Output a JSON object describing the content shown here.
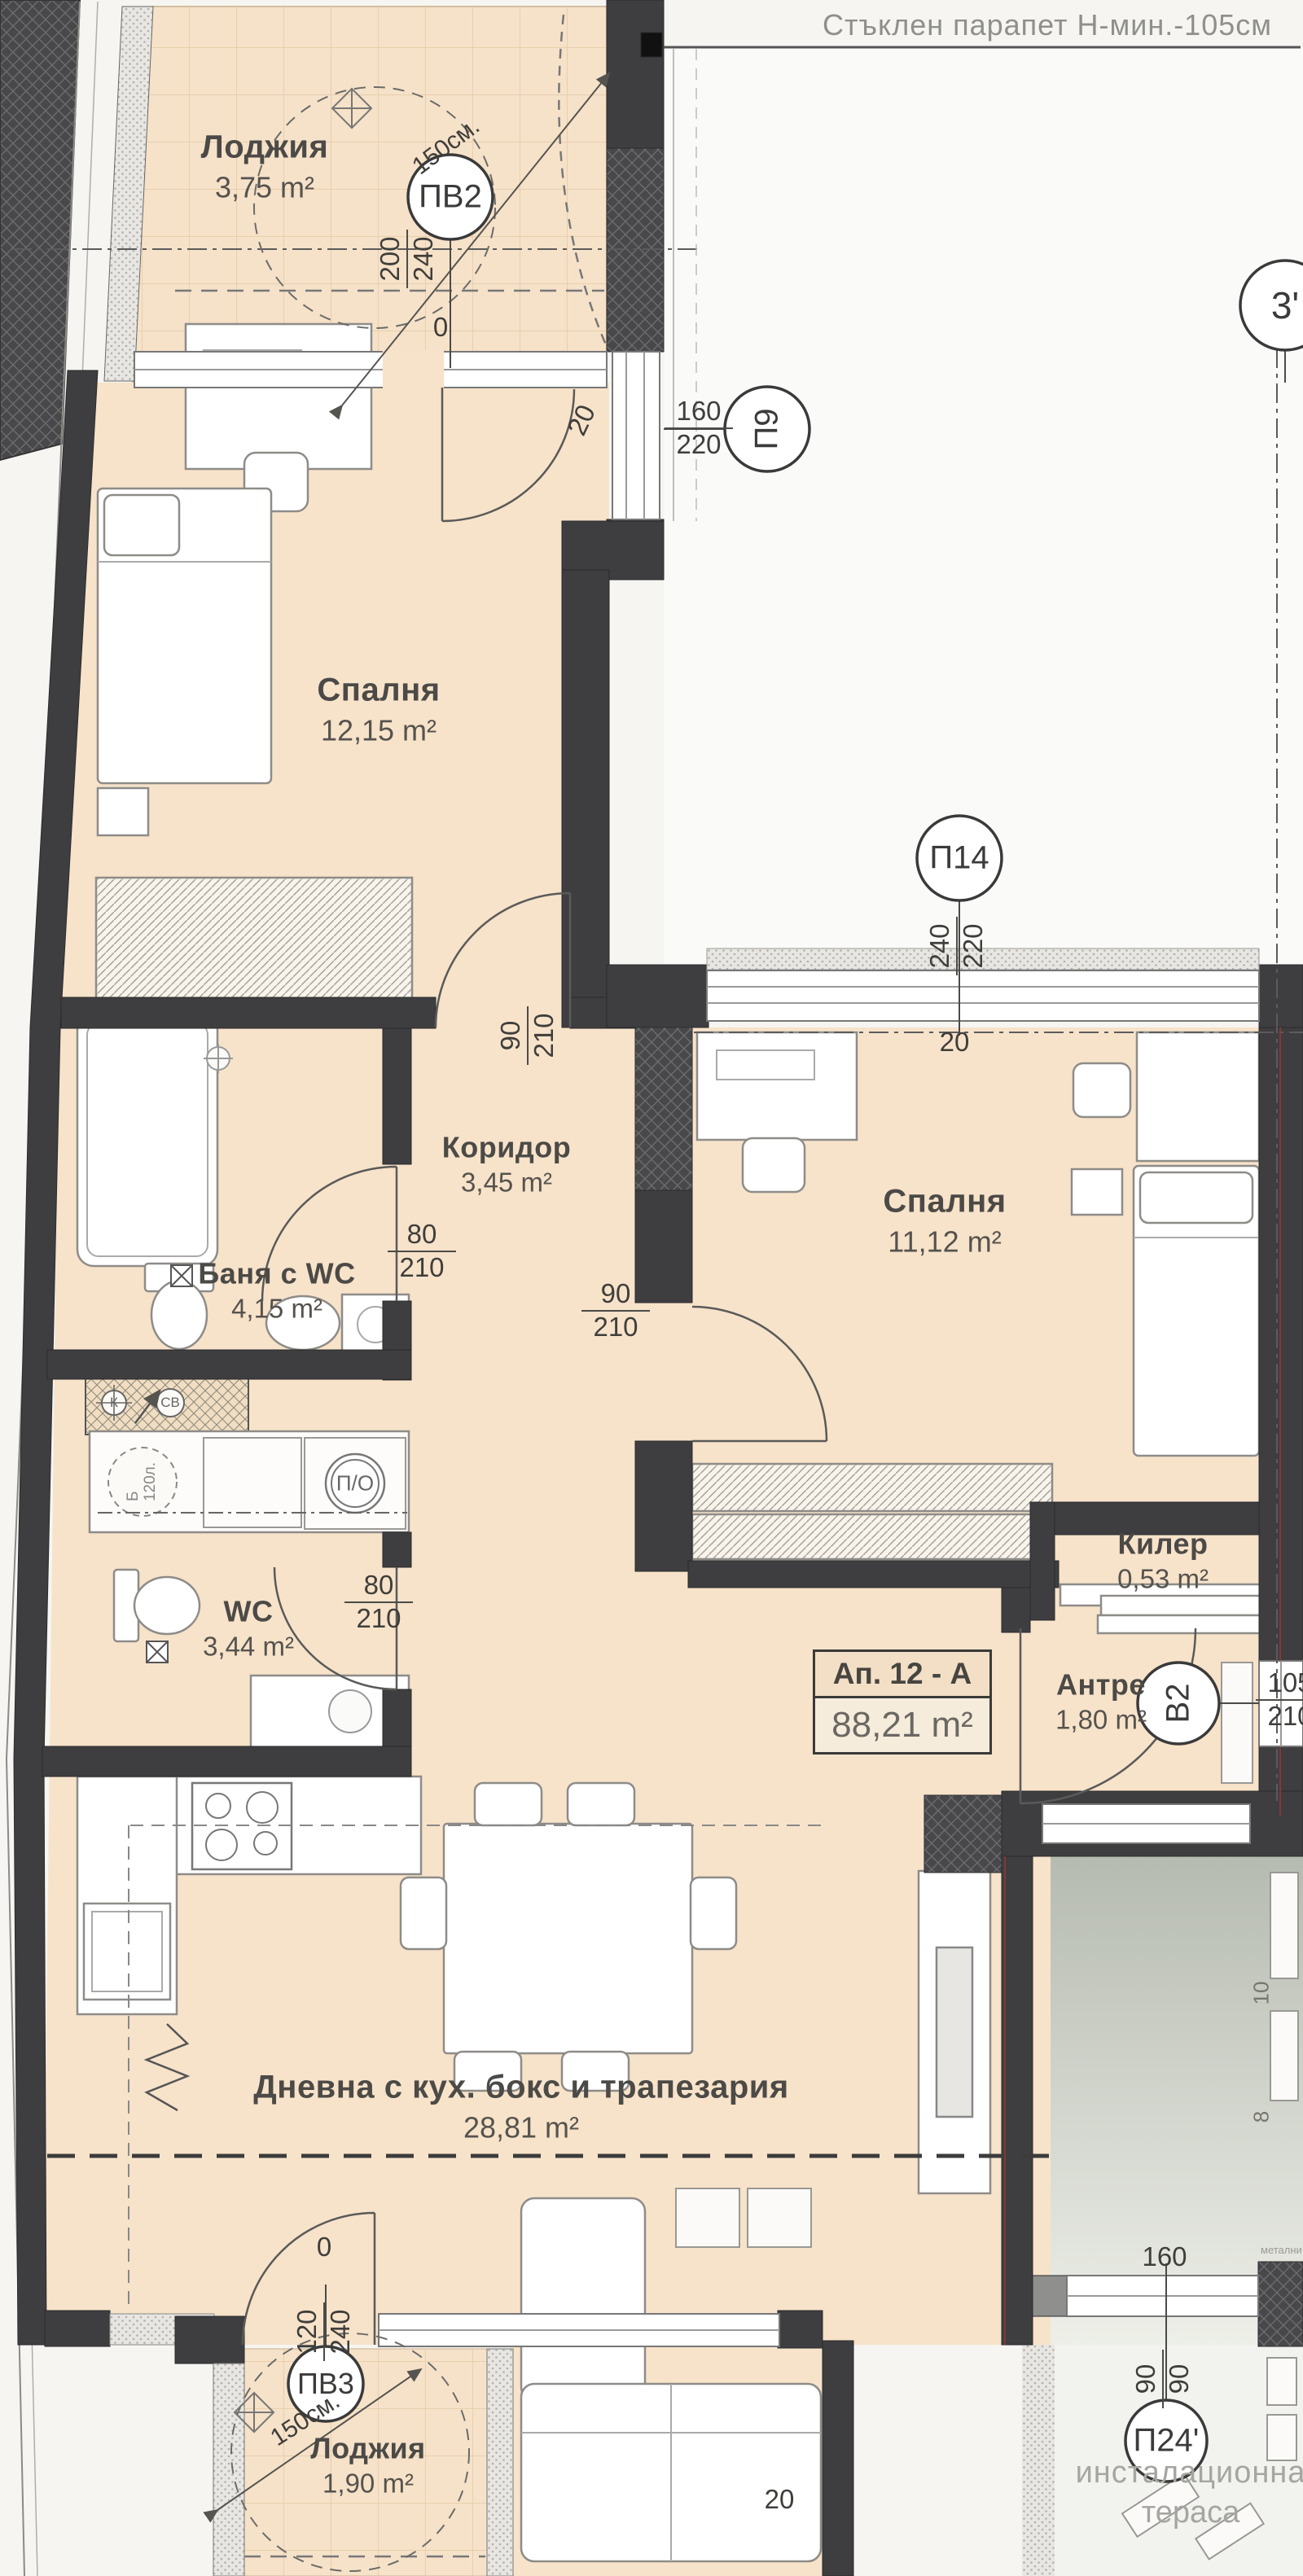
{
  "note_top": "Стъклен парапет Н-мин.-105см",
  "apartment_box": {
    "name": "Ап. 12 - А",
    "area": "88,21 m²"
  },
  "rooms": {
    "loggia_top": {
      "name": "Лоджия",
      "area": "3,75 m²"
    },
    "bedroom1": {
      "name": "Спалня",
      "area": "12,15 m²"
    },
    "corridor": {
      "name": "Коридор",
      "area": "3,45 m²"
    },
    "bath": {
      "name": "Баня с WC",
      "area": "4,15 m²"
    },
    "wc": {
      "name": "WC",
      "area": "3,44 m²"
    },
    "bedroom2": {
      "name": "Спалня",
      "area": "11,12 m²"
    },
    "storage": {
      "name": "Килер",
      "area": "0,53 m²"
    },
    "entry": {
      "name": "Антре",
      "area": "1,80 m²"
    },
    "living": {
      "name": "Дневна с кух. бокс и трапезария",
      "area": "28,81 m²"
    },
    "loggia_bottom": {
      "name": "Лоджия",
      "area": "1,90 m²"
    },
    "terrace": {
      "line1": "инсталационна",
      "line2": "тераса"
    }
  },
  "markers": {
    "pv2": "ПВ2",
    "p9": "П9",
    "p14": "П14",
    "v2": "В2",
    "pv3": "ПВ3",
    "p24": "П24'",
    "axis3": "3'",
    "po": "П/О",
    "k": "К",
    "sv": "СВ",
    "boiler_line1": "Б",
    "boiler_line2": "120л."
  },
  "dims": {
    "door_top": {
      "a": "200",
      "b": "240"
    },
    "p9": {
      "a": "160",
      "b": "220"
    },
    "p14": {
      "a": "240",
      "b": "220"
    },
    "bedroom1_door": {
      "a": "90",
      "b": "210"
    },
    "bath_door": {
      "a": "80",
      "b": "210"
    },
    "bedroom2_door": {
      "a": "90",
      "b": "210"
    },
    "wc_door": {
      "a": "80",
      "b": "210"
    },
    "entry_door": {
      "a": "105",
      "b": "210"
    },
    "loggia_bottom_door": {
      "a": "120",
      "b": "240"
    },
    "terrace_window": {
      "a": "90",
      "b": "90"
    },
    "terrace_width": "160",
    "twenty": "20",
    "zero": "0",
    "diag": "150см.",
    "side10": "10",
    "side8": "8",
    "metal": "метални"
  },
  "colors": {
    "floor": "#f7e3ca",
    "wall": "#3e3e40",
    "accent_red": "#8d3a34",
    "gray_text": "#8f8f8b"
  }
}
